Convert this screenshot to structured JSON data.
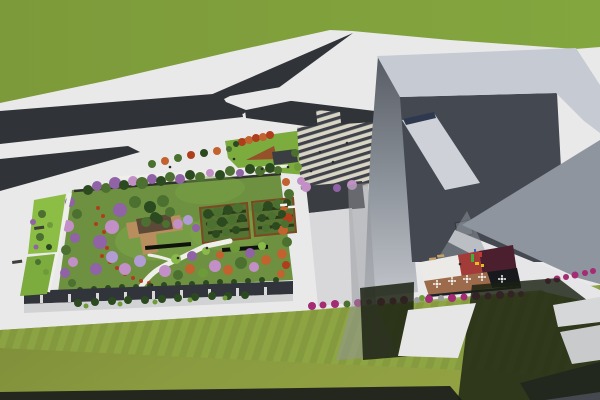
{
  "scene": {
    "kind": "3d-architectural-aerial-render",
    "subject": "cultural complex with rooftop garden park, Y-shaped road, striped entry plaza and angular gray tower with courtyard cafe"
  },
  "palette": {
    "pavement": "#e9e9ea",
    "pavement2": "#e6e6e8",
    "grass_top1": "#7d9a3a",
    "grass_top2": "#83a63e",
    "grass_bottom": "#8a9b40",
    "grass_bottom2": "#7d8c39",
    "stripe_a": "#84993e",
    "stripe_b": "#8ea644",
    "road": "#303338",
    "road_light": "#45484e",
    "road_strip": "#24271e",
    "roof_band": "#c6cad3",
    "inner_dark": "#434851",
    "face_right": "#8f959e",
    "skylight": "#ced1d7",
    "skylight_strip": "#2e3950",
    "vent": "#5f646d",
    "court_white": "#eceae6",
    "court_red": "#a33b38",
    "court_maroon": "#4b1f2d",
    "court_dark": "#17191d",
    "deck_brown": "#9c6b4b",
    "deck_edge": "#1e2126",
    "wing_wall": "#d8d8da",
    "garden_base": "#6d9140",
    "lawn_light": "#7ea748",
    "grove_fill": "#567331",
    "grove_border": "#7c4a22",
    "grove_row": "#2a3b19",
    "path_white": "#efefe9",
    "facade_dark": "#31343a",
    "facade_shadow": "#c6c7c9",
    "ne_lawn": "#7cab3e",
    "amphi_brown": "#94512a",
    "canopy_dark": "#3a3d42",
    "plaza_light": "#d8d5c4",
    "plaza_dark": "#3f424a",
    "strip_green1": "#8cbd45",
    "strip_green2": "#7cab3e",
    "shadow_dark": "#1b2112",
    "shadow_gray": "#93969b",
    "pav_deck": "#b98e5e",
    "pav_roof": "#5d4937",
    "bar_black": "#0e120d",
    "west_bar": "#3c4036",
    "pilaster": "#d8d8d6",
    "dg": "#2c4a1f",
    "mg": "#4c7030",
    "lg": "#6f9a39",
    "bg": "#8ab84a",
    "pu": "#8f63a6",
    "pk": "#c290c6",
    "lav": "#b19cd4",
    "or": "#c2622f",
    "ro": "#ae3e1c",
    "mag": "#a32c74",
    "gray": "#9b9da0",
    "tan": "#c8a06a",
    "wt": "#f2f2f0",
    "person": "#2b2b2b"
  },
  "scatter": {
    "garden_trees": [
      [
        88,
        190,
        5,
        "dg"
      ],
      [
        97,
        186,
        5,
        "pu"
      ],
      [
        106,
        188,
        5,
        "mg"
      ],
      [
        115,
        183,
        6,
        "pu"
      ],
      [
        124,
        185,
        5,
        "dg"
      ],
      [
        133,
        181,
        5,
        "pk"
      ],
      [
        142,
        183,
        6,
        "mg"
      ],
      [
        152,
        179,
        5,
        "pu"
      ],
      [
        161,
        181,
        5,
        "dg"
      ],
      [
        170,
        177,
        5,
        "mg"
      ],
      [
        180,
        179,
        5,
        "pu"
      ],
      [
        190,
        175,
        5,
        "dg"
      ],
      [
        200,
        177,
        5,
        "mg"
      ],
      [
        210,
        173,
        4,
        "pk"
      ],
      [
        220,
        175,
        5,
        "dg"
      ],
      [
        230,
        171,
        5,
        "mg"
      ],
      [
        240,
        173,
        4,
        "pu"
      ],
      [
        250,
        169,
        5,
        "dg"
      ],
      [
        260,
        171,
        5,
        "mg"
      ],
      [
        270,
        168,
        5,
        "dg"
      ],
      [
        278,
        170,
        4,
        "mg"
      ],
      [
        286,
        182,
        4,
        "or"
      ],
      [
        289,
        194,
        5,
        "mg"
      ],
      [
        284,
        206,
        5,
        "or"
      ],
      [
        288,
        218,
        5,
        "ro"
      ],
      [
        283,
        230,
        5,
        "or"
      ],
      [
        287,
        242,
        5,
        "mg"
      ],
      [
        282,
        254,
        5,
        "or"
      ],
      [
        286,
        265,
        4,
        "ro"
      ],
      [
        281,
        274,
        4,
        "or"
      ],
      [
        70,
        202,
        5,
        "pu"
      ],
      [
        77,
        214,
        5,
        "mg"
      ],
      [
        68,
        226,
        6,
        "pk"
      ],
      [
        75,
        238,
        5,
        "pu"
      ],
      [
        66,
        250,
        5,
        "mg"
      ],
      [
        73,
        262,
        5,
        "pk"
      ],
      [
        65,
        273,
        5,
        "pu"
      ],
      [
        72,
        283,
        4,
        "mg"
      ],
      [
        120,
        210,
        7,
        "pu"
      ],
      [
        135,
        202,
        6,
        "mg"
      ],
      [
        150,
        207,
        6,
        "dg"
      ],
      [
        163,
        201,
        6,
        "mg"
      ],
      [
        112,
        227,
        7,
        "pk"
      ],
      [
        100,
        242,
        7,
        "pu"
      ],
      [
        112,
        257,
        6,
        "lav"
      ],
      [
        96,
        269,
        6,
        "pu"
      ],
      [
        125,
        269,
        6,
        "pk"
      ],
      [
        140,
        261,
        6,
        "lav"
      ],
      [
        155,
        217,
        5,
        "dg"
      ],
      [
        170,
        212,
        5,
        "mg"
      ],
      [
        178,
        224,
        5,
        "pk"
      ],
      [
        188,
        220,
        5,
        "lav"
      ],
      [
        196,
        228,
        4,
        "pu"
      ],
      [
        208,
        214,
        5,
        "dg"
      ],
      [
        218,
        212,
        5,
        "mg"
      ],
      [
        228,
        210,
        5,
        "dg"
      ],
      [
        238,
        208,
        5,
        "mg"
      ],
      [
        212,
        224,
        5,
        "mg"
      ],
      [
        222,
        222,
        5,
        "dg"
      ],
      [
        232,
        220,
        5,
        "mg"
      ],
      [
        242,
        218,
        4,
        "dg"
      ],
      [
        216,
        234,
        4,
        "dg"
      ],
      [
        226,
        232,
        4,
        "mg"
      ],
      [
        236,
        230,
        4,
        "dg"
      ],
      [
        258,
        208,
        5,
        "mg"
      ],
      [
        268,
        206,
        5,
        "dg"
      ],
      [
        278,
        204,
        5,
        "mg"
      ],
      [
        287,
        203,
        4,
        "dg"
      ],
      [
        262,
        218,
        4,
        "dg"
      ],
      [
        272,
        216,
        4,
        "mg"
      ],
      [
        282,
        214,
        4,
        "dg"
      ],
      [
        266,
        228,
        4,
        "mg"
      ],
      [
        276,
        226,
        4,
        "dg"
      ],
      [
        285,
        224,
        4,
        "mg"
      ],
      [
        165,
        271,
        6,
        "pk"
      ],
      [
        178,
        275,
        5,
        "mg"
      ],
      [
        190,
        269,
        5,
        "or"
      ],
      [
        203,
        273,
        5,
        "lg"
      ],
      [
        215,
        266,
        6,
        "pk"
      ],
      [
        228,
        270,
        5,
        "or"
      ],
      [
        241,
        263,
        6,
        "mg"
      ],
      [
        254,
        267,
        5,
        "pk"
      ],
      [
        266,
        260,
        5,
        "or"
      ],
      [
        176,
        259,
        5,
        "bg"
      ],
      [
        192,
        256,
        5,
        "pu"
      ],
      [
        206,
        251,
        4,
        "bg"
      ],
      [
        220,
        255,
        4,
        "or"
      ],
      [
        235,
        248,
        5,
        "lg"
      ],
      [
        250,
        253,
        5,
        "pu"
      ],
      [
        262,
        246,
        4,
        "bg"
      ],
      [
        146,
        222,
        5,
        "mg"
      ],
      [
        158,
        219,
        5,
        "dg"
      ],
      [
        166,
        224,
        4,
        "mg"
      ]
    ],
    "hedge_row": [
      [
        80,
        290,
        3,
        "dg"
      ],
      [
        94,
        289,
        3,
        "dg"
      ],
      [
        108,
        288,
        3,
        "dg"
      ],
      [
        122,
        287,
        3,
        "dg"
      ],
      [
        136,
        287,
        3,
        "dg"
      ],
      [
        150,
        286,
        3,
        "dg"
      ],
      [
        164,
        285,
        3,
        "dg"
      ],
      [
        178,
        284,
        3,
        "dg"
      ],
      [
        192,
        284,
        3,
        "dg"
      ],
      [
        206,
        283,
        3,
        "dg"
      ],
      [
        220,
        282,
        3,
        "dg"
      ],
      [
        234,
        282,
        3,
        "dg"
      ],
      [
        248,
        281,
        3,
        "dg"
      ],
      [
        262,
        280,
        3,
        "dg"
      ],
      [
        276,
        280,
        3,
        "dg"
      ]
    ],
    "flower_dots": [
      [
        98,
        208,
        2,
        "ro"
      ],
      [
        103,
        216,
        2,
        "ro"
      ],
      [
        96,
        224,
        2,
        "ro"
      ],
      [
        104,
        232,
        2,
        "ro"
      ],
      [
        99,
        240,
        2,
        "ro"
      ],
      [
        107,
        248,
        2,
        "ro"
      ],
      [
        102,
        256,
        2,
        "ro"
      ],
      [
        110,
        262,
        2,
        "ro"
      ],
      [
        117,
        268,
        2,
        "ro"
      ],
      [
        125,
        274,
        2,
        "ro"
      ],
      [
        133,
        278,
        2,
        "ro"
      ],
      [
        141,
        281,
        2,
        "ro"
      ],
      [
        149,
        283,
        2,
        "ro"
      ]
    ],
    "street_trees": [
      [
        152,
        164,
        4,
        "mg"
      ],
      [
        165,
        161,
        4,
        "or"
      ],
      [
        178,
        158,
        4,
        "mg"
      ],
      [
        191,
        155,
        4,
        "ro"
      ],
      [
        204,
        153,
        4,
        "dg"
      ],
      [
        217,
        151,
        4,
        "or"
      ],
      [
        229,
        149,
        3,
        "mg"
      ]
    ],
    "ne_trees": [
      [
        242,
        142,
        4,
        "ro"
      ],
      [
        249,
        140,
        4,
        "or"
      ],
      [
        256,
        138,
        4,
        "ro"
      ],
      [
        263,
        137,
        4,
        "or"
      ],
      [
        270,
        135,
        4,
        "ro"
      ],
      [
        236,
        144,
        3,
        "dg"
      ]
    ],
    "plaza_trees": [
      [
        295,
        153,
        4,
        "mg"
      ],
      [
        298,
        167,
        4,
        "lg"
      ],
      [
        301,
        181,
        4,
        "pk"
      ],
      [
        306,
        187,
        5,
        "pk"
      ],
      [
        352,
        185,
        5,
        "pk"
      ],
      [
        337,
        188,
        4,
        "pu"
      ]
    ],
    "west_bushes": [
      [
        42,
        214,
        4,
        "mg"
      ],
      [
        50,
        225,
        3,
        "lg"
      ],
      [
        40,
        237,
        4,
        "mg"
      ],
      [
        49,
        247,
        3,
        "dg"
      ],
      [
        38,
        262,
        3,
        "mg"
      ],
      [
        46,
        272,
        3,
        "lg"
      ],
      [
        33,
        222,
        3,
        "pu"
      ],
      [
        36,
        247,
        2.5,
        "pu"
      ]
    ],
    "street_bushes": [
      [
        312,
        306,
        4,
        "mag"
      ],
      [
        323,
        305,
        3.5,
        "mag"
      ],
      [
        335,
        304,
        4,
        "mag"
      ],
      [
        347,
        304,
        3.5,
        "mg"
      ],
      [
        358,
        303,
        4,
        "mag"
      ],
      [
        369,
        302,
        3,
        "mag"
      ],
      [
        381,
        302,
        4,
        "mag"
      ],
      [
        393,
        301,
        3.5,
        "mag"
      ],
      [
        404,
        300,
        4,
        "mag"
      ],
      [
        417,
        300,
        3,
        "gray"
      ],
      [
        422,
        298,
        3,
        "lg"
      ],
      [
        429,
        299,
        4,
        "mag"
      ],
      [
        441,
        298,
        3,
        "gray"
      ],
      [
        452,
        298,
        4,
        "mag"
      ],
      [
        464,
        297,
        3.5,
        "mag"
      ],
      [
        476,
        296,
        4,
        "mag"
      ],
      [
        488,
        296,
        3.5,
        "mag"
      ],
      [
        500,
        295,
        4,
        "mag"
      ],
      [
        511,
        294,
        3.5,
        "mag"
      ],
      [
        521,
        294,
        3,
        "mag"
      ]
    ],
    "right_bushes": [
      [
        548,
        281,
        3,
        "mag"
      ],
      [
        557,
        279,
        3.5,
        "mag"
      ],
      [
        566,
        277,
        3,
        "mag"
      ],
      [
        575,
        275,
        3.5,
        "mag"
      ],
      [
        585,
        273,
        3,
        "mag"
      ],
      [
        593,
        271,
        3,
        "mag"
      ]
    ],
    "facade_hedges": [
      [
        78,
        303,
        4,
        "dg"
      ],
      [
        95,
        302,
        4,
        "dg"
      ],
      [
        112,
        301,
        4,
        "dg"
      ],
      [
        128,
        300,
        4,
        "dg"
      ],
      [
        145,
        300,
        4,
        "dg"
      ],
      [
        162,
        299,
        4,
        "dg"
      ],
      [
        178,
        298,
        4,
        "dg"
      ],
      [
        195,
        297,
        4,
        "dg"
      ],
      [
        212,
        296,
        4,
        "dg"
      ],
      [
        228,
        296,
        4,
        "dg"
      ],
      [
        245,
        295,
        4,
        "dg"
      ],
      [
        86,
        306,
        2.5,
        "lg"
      ],
      [
        120,
        304,
        2.5,
        "lg"
      ],
      [
        155,
        302,
        2.5,
        "lg"
      ],
      [
        190,
        300,
        2.5,
        "lg"
      ],
      [
        225,
        298,
        2.5,
        "lg"
      ]
    ],
    "people": [
      [
        320,
        152,
        1.3,
        "person"
      ],
      [
        333,
        162,
        1.3,
        "person"
      ],
      [
        347,
        143,
        1.3,
        "person"
      ],
      [
        311,
        171,
        1.3,
        "person"
      ],
      [
        288,
        167,
        1.3,
        "person"
      ],
      [
        262,
        169,
        1.3,
        "person"
      ],
      [
        234,
        159,
        1.3,
        "person"
      ],
      [
        170,
        167,
        1.3,
        "person"
      ],
      [
        178,
        258,
        1.3,
        "person"
      ],
      [
        152,
        285,
        1.3,
        "person"
      ],
      [
        207,
        248,
        1.3,
        "person"
      ],
      [
        460,
        264,
        1.3,
        "person"
      ]
    ]
  },
  "rects": {
    "pilasters": {
      "fill": "pilaster",
      "items": [
        [
          40,
          295,
          3,
          8
        ],
        [
          68,
          294,
          3,
          8
        ],
        [
          96,
          293,
          3,
          8
        ],
        [
          124,
          292,
          3,
          8
        ],
        [
          152,
          291,
          3,
          8
        ],
        [
          180,
          290,
          3,
          8
        ],
        [
          208,
          289,
          3,
          8
        ],
        [
          236,
          288,
          3,
          8
        ],
        [
          264,
          287,
          3,
          8
        ]
      ]
    },
    "benches_tan": {
      "fill": "tan",
      "items": [
        [
          429,
          258,
          7,
          2.5,
          -6
        ],
        [
          437,
          255,
          7,
          2.5,
          -6
        ]
      ]
    },
    "white_benches": {
      "fill": "wt",
      "items": [
        [
          280,
          204,
          7,
          2.5,
          -5
        ],
        [
          288,
          206,
          7,
          2.5,
          -5
        ]
      ]
    },
    "park_bars": {
      "fill": "bar_black",
      "items": [
        [
          145,
          246,
          46,
          4,
          -5
        ],
        [
          222,
          248,
          46,
          4,
          -4
        ]
      ]
    },
    "west_bars": {
      "fill": "west_bar",
      "items": [
        [
          34,
          227,
          10,
          3,
          -8
        ],
        [
          12,
          261,
          10,
          3,
          -8
        ]
      ]
    },
    "playground": {
      "fill": null,
      "items": [
        [
          471,
          254,
          3,
          8,
          0,
          "#3fae3c"
        ],
        [
          475,
          262,
          4,
          3,
          0,
          "#e4bd1f"
        ],
        [
          479,
          252,
          3,
          5,
          0,
          "#c23a35"
        ],
        [
          474,
          249,
          2,
          3,
          0,
          "#3a62c4"
        ],
        [
          481,
          264,
          3,
          3,
          0,
          "#e4bd1f"
        ]
      ]
    }
  },
  "cafe_tables": [
    [
      437,
      284
    ],
    [
      452,
      281
    ],
    [
      467,
      279
    ],
    [
      482,
      277
    ],
    [
      502,
      279
    ]
  ]
}
